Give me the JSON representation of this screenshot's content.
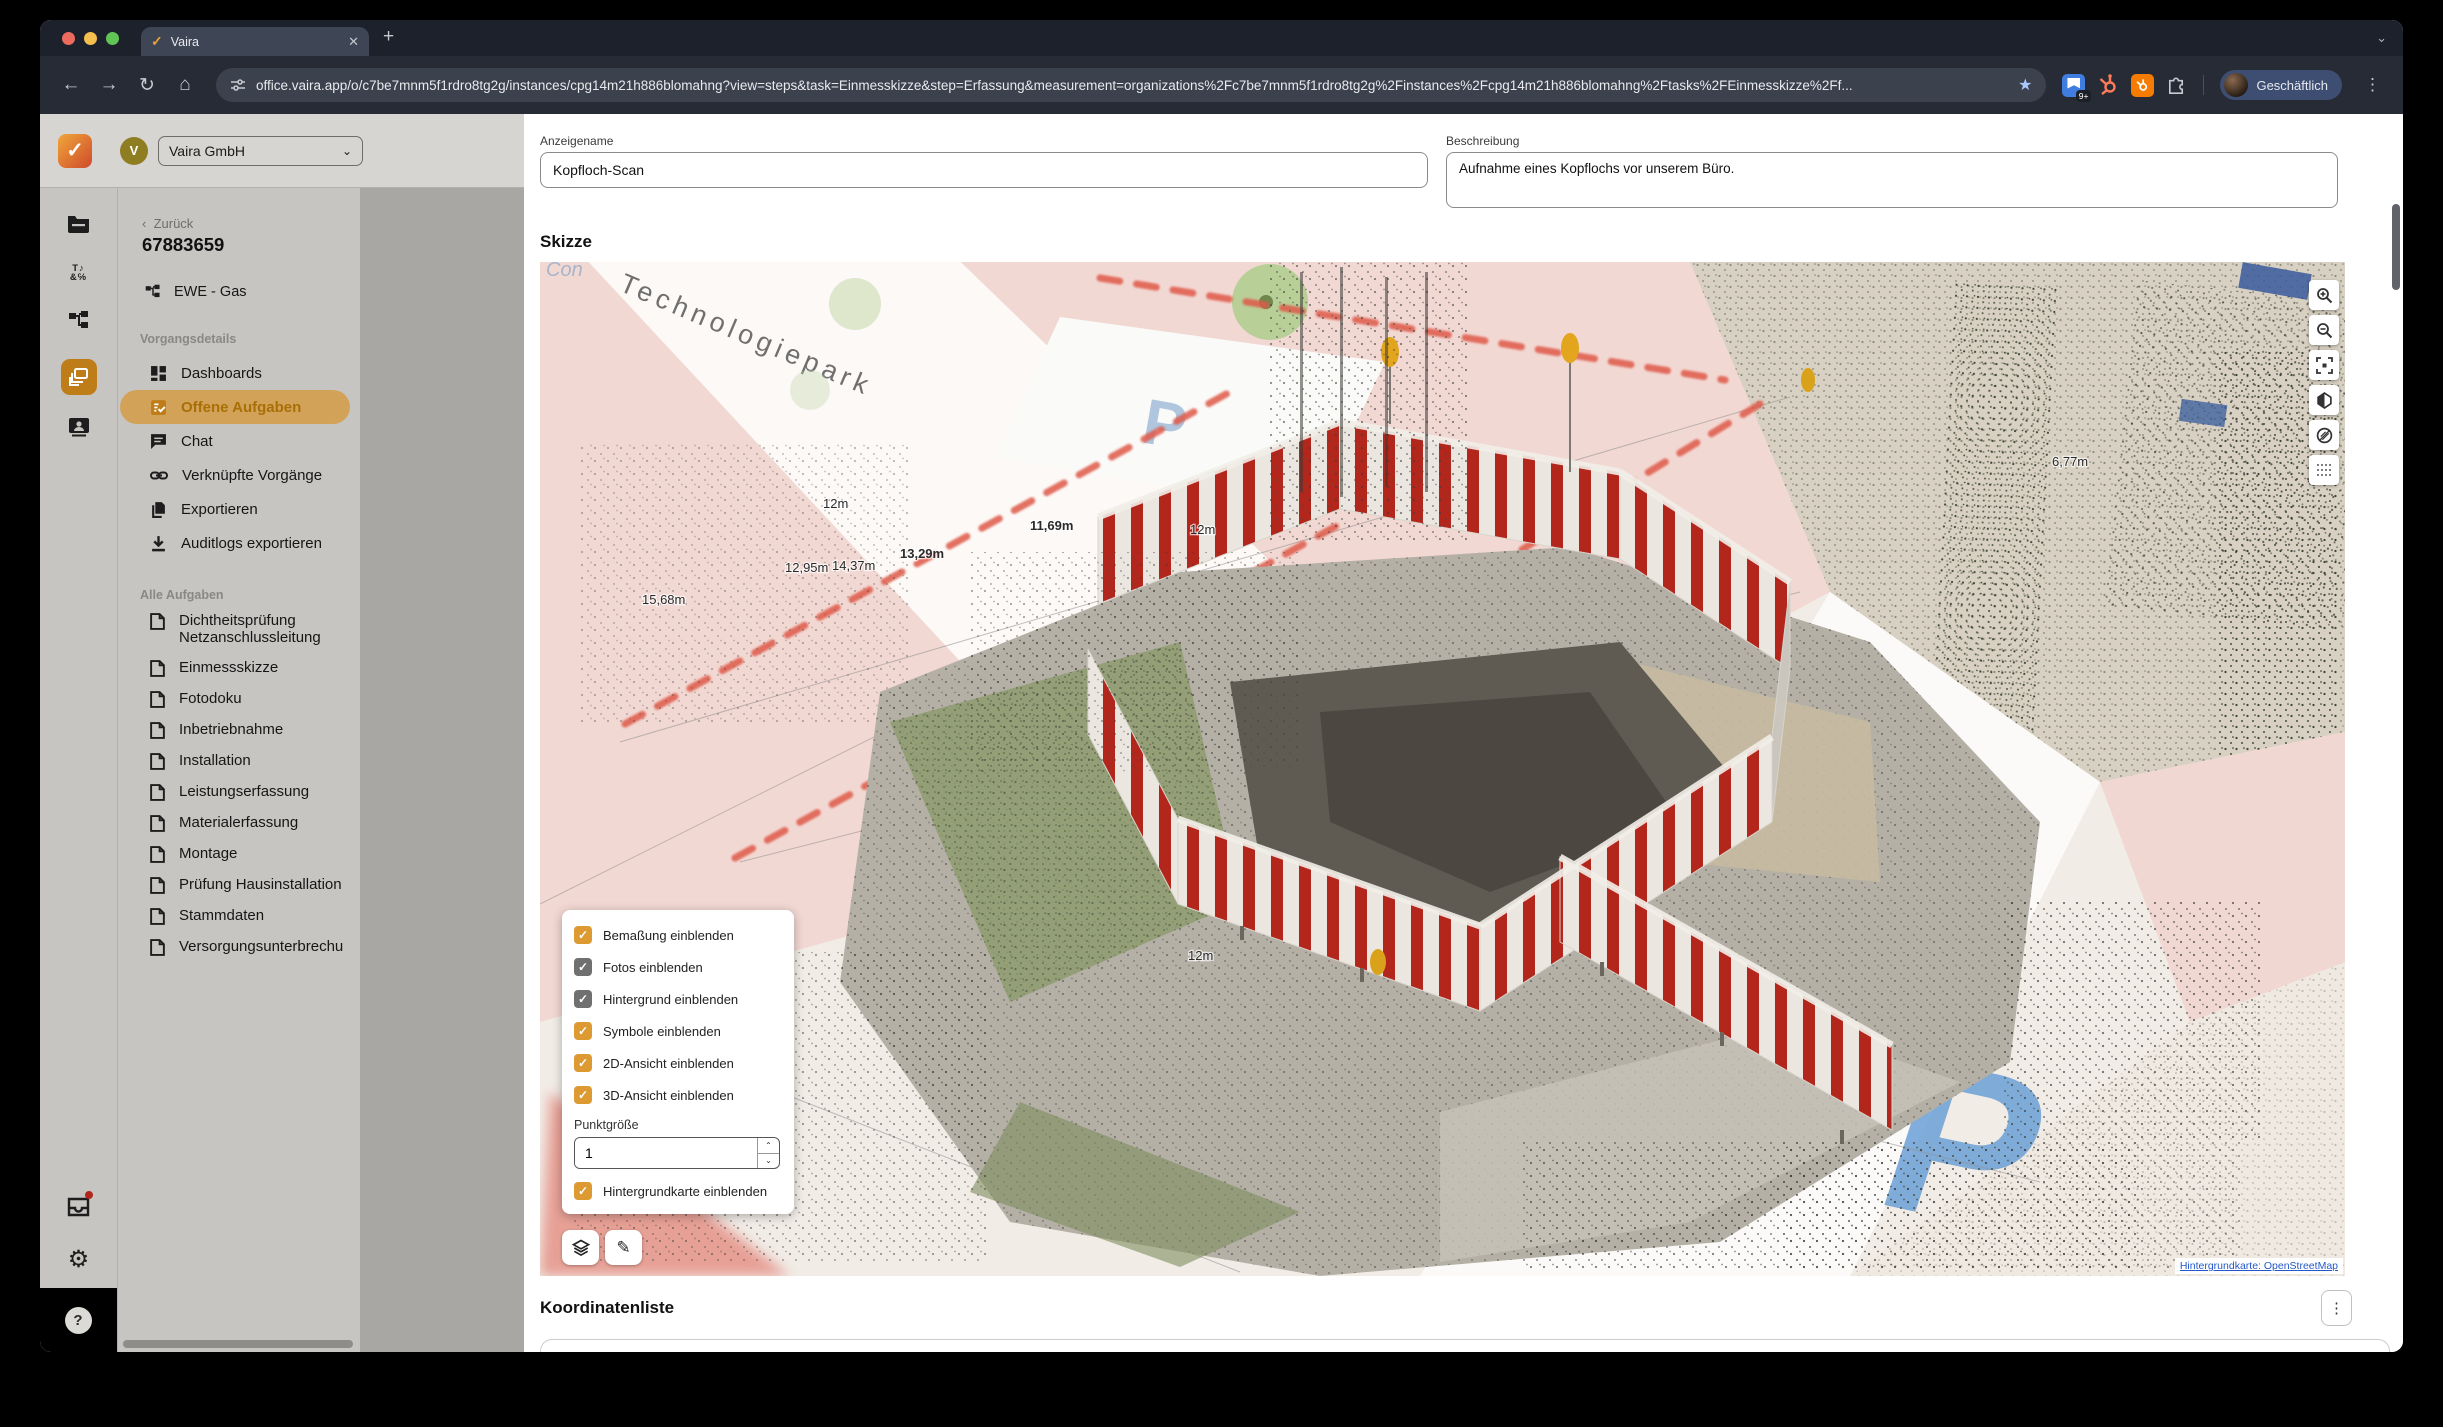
{
  "colors": {
    "accent_orange": "#dd9a33",
    "active_pill": "#d2a258",
    "brand_gradient_from": "#f0a63a",
    "brand_gradient_to": "#cf4a2b",
    "checkbox_gray": "#707070",
    "barrier_red": "#b3261c",
    "map_pink": "#f2d8d3",
    "link_blue": "#2458c8"
  },
  "browser": {
    "tab_title": "Vaira",
    "url": "office.vaira.app/o/c7be7mnm5f1rdro8tg2g/instances/cpg14m21h886blomahng?view=steps&task=Einmesskizze&step=Erfassung&measurement=organizations%2Fc7be7mnm5f1rdro8tg2g%2Finstances%2Fcpg14m21h886blomahng%2Ftasks%2FEinmesskizze%2Ff...",
    "ext_badge": "9+",
    "profile_label": "Geschäftlich"
  },
  "sidebar": {
    "org_letter": "V",
    "org_name": "Vaira GmbH",
    "back_label": "Zurück",
    "case_number": "67883659",
    "case_type": "EWE - Gas",
    "details_title": "Vorgangsdetails",
    "details_items": [
      {
        "label": "Dashboards"
      },
      {
        "label": "Offene Aufgaben"
      },
      {
        "label": "Chat"
      },
      {
        "label": "Verknüpfte Vorgänge"
      },
      {
        "label": "Exportieren"
      },
      {
        "label": "Auditlogs exportieren"
      }
    ],
    "tasks_title": "Alle Aufgaben",
    "tasks": [
      "Dichtheitsprüfung Netzanschlussleitung",
      "Einmessskizze",
      "Fotodoku",
      "Inbetriebnahme",
      "Installation",
      "Leistungserfassung",
      "Materialerfassung",
      "Montage",
      "Prüfung Hausinstallation",
      "Stammdaten",
      "Versorgungsunterbrechung"
    ]
  },
  "main": {
    "fields": {
      "name_label": "Anzeigename",
      "name_value": "Kopfloch-Scan",
      "desc_label": "Beschreibung",
      "desc_value": "Aufnahme eines Kopflochs vor unserem Büro."
    },
    "sketch": {
      "title": "Skizze",
      "street_label": "Technologiepark",
      "parking_letter": "P",
      "attribution": "Hintergrundkarte: OpenStreetMap",
      "measurements": [
        "12m",
        "11,69m",
        "12m",
        "13,29m",
        "12,95m",
        "14,37m",
        "15,68m",
        "6,77m",
        "12m"
      ],
      "panel": {
        "items": [
          {
            "label": "Bemaßung einblenden",
            "checked": true,
            "style": "orange"
          },
          {
            "label": "Fotos einblenden",
            "checked": true,
            "style": "gray"
          },
          {
            "label": "Hintergrund einblenden",
            "checked": true,
            "style": "gray"
          },
          {
            "label": "Symbole einblenden",
            "checked": true,
            "style": "orange"
          },
          {
            "label": "2D-Ansicht einblenden",
            "checked": true,
            "style": "orange"
          },
          {
            "label": "3D-Ansicht einblenden",
            "checked": true,
            "style": "orange"
          }
        ],
        "point_size_label": "Punktgröße",
        "point_size_value": "1",
        "map_checkbox_label": "Hintergrundkarte einblenden"
      }
    },
    "coords": {
      "title": "Koordinatenliste",
      "columns": [
        "Index",
        "Feature",
        "x",
        "y",
        "z",
        "Zeitstempel"
      ]
    }
  }
}
